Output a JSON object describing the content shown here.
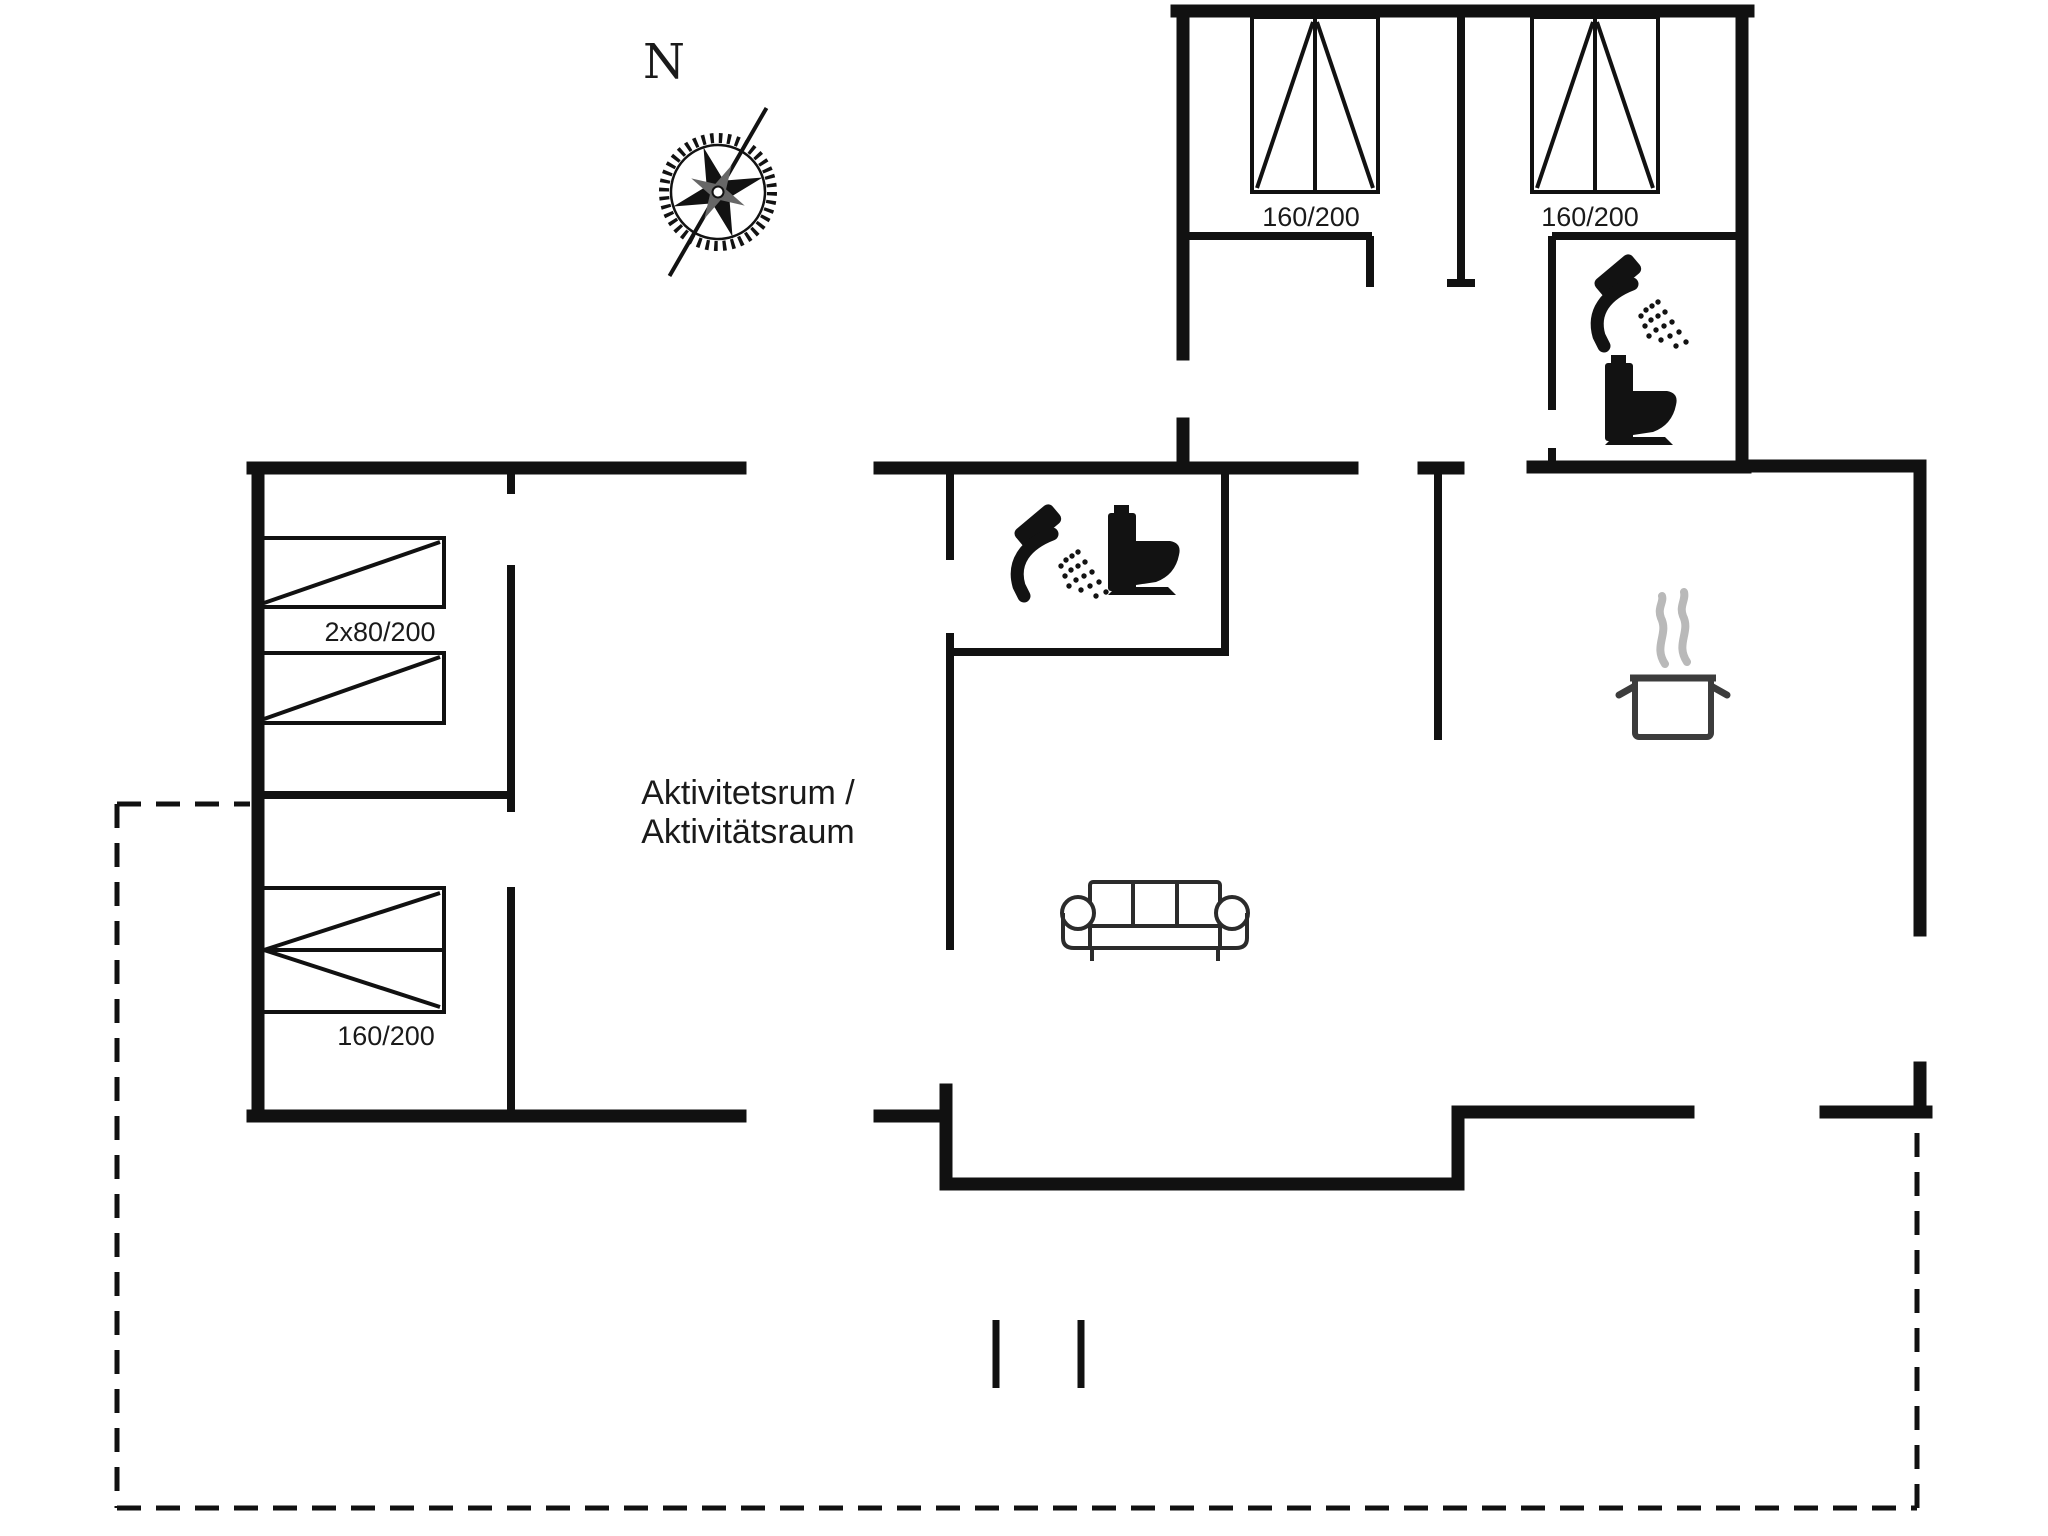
{
  "document": {
    "type": "floor-plan",
    "background": "#ffffff"
  },
  "compass": {
    "label": "N"
  },
  "labels": {
    "bedroom1_bed": "160/200",
    "bedroom2_bed": "160/200",
    "bunk_bed": "2x80/200",
    "double_bed": "160/200",
    "activity_room_line1": "Aktivitetsrum /",
    "activity_room_line2": "Aktivitätsraum"
  },
  "icons": {
    "compass_rose": "eight-point compass rose with toothed ring and long needle",
    "shower": "handheld shower head with spray drops",
    "toilet": "toilet side silhouette",
    "cooking_pot": "steaming cooking pot (kitchen)",
    "sofa": "three-seat sofa",
    "bed_symbols": "bed rectangles with diagonal fold lines"
  },
  "colors": {
    "bg": "#ffffff",
    "wall": "#111111",
    "icon_black": "#121212",
    "pot_outline": "#3c3c3c",
    "steam_gray": "#b9b9b9",
    "sofa_outline": "#2b2b2b",
    "text": "#1a1a1a"
  }
}
